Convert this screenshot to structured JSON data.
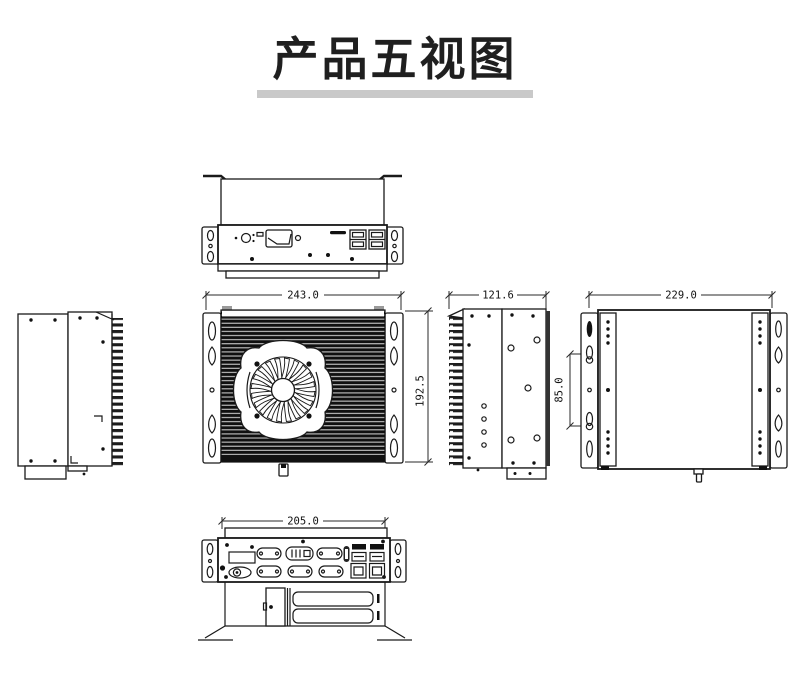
{
  "page": {
    "title": "产品五视图",
    "background": "#ffffff",
    "line_color": "#1a1a1a",
    "underline_color": "#c9c9c9",
    "heatsink_color": "#101010"
  },
  "dimensions": {
    "front_width": "243.0",
    "front_height": "192.5",
    "side_depth": "121.6",
    "back_width": "229.0",
    "mount_slot_spacing": "85.0",
    "rear_panel_width": "205.0"
  }
}
